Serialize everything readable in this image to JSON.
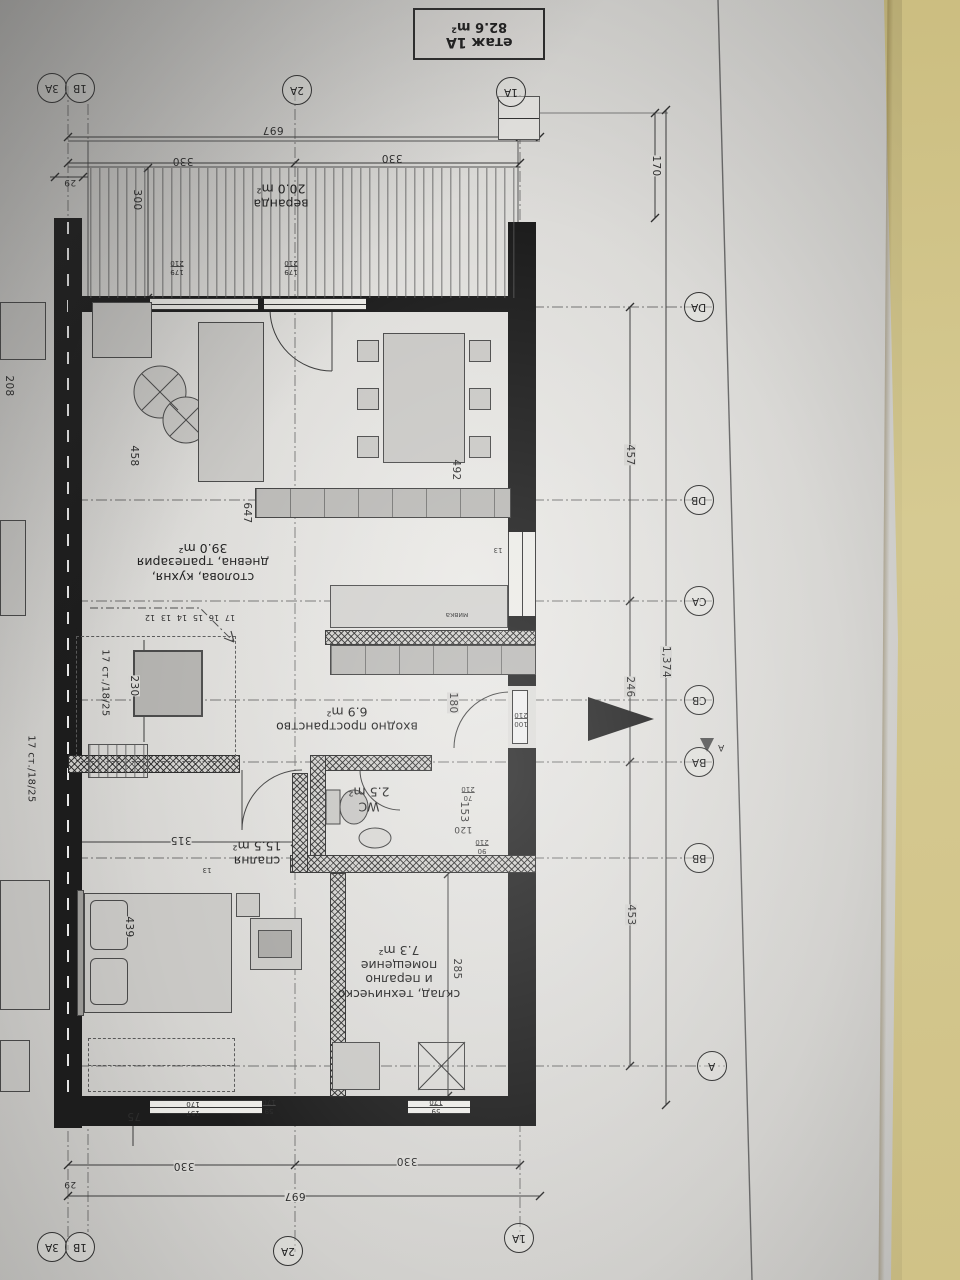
{
  "title_block": {
    "line1": "етаж 1А",
    "line2": "82.6 m²"
  },
  "rooms": {
    "veranda": {
      "name": "веранда",
      "area": "20.0 m²"
    },
    "living": {
      "name_line1": "столова, кухня,",
      "name_line2": "дневна, трапезария",
      "area": "39.0 m²"
    },
    "entry": {
      "name": "входно пространство",
      "area": "6.9 m²"
    },
    "wc": {
      "name": "WC",
      "area": "2.5 m²"
    },
    "bedroom": {
      "name": "спалня",
      "area": "15.5 m²"
    },
    "storage": {
      "name_line1": "склад, техническо",
      "name_line2": "и перално",
      "name_line3": "помещение",
      "area": "7.3 m²"
    }
  },
  "grid_bubbles": {
    "top_pair_left": "3А",
    "top_pair_right": "1В",
    "top_2a": "2А",
    "top_1a": "1А",
    "bottom_pair_left": "3А",
    "bottom_pair_right": "1В",
    "bottom_2a": "2А",
    "bottom_1a": "1А",
    "right": [
      "DA",
      "DB",
      "CA",
      "CB",
      "BA",
      "BB",
      "A"
    ],
    "section_marker": "А"
  },
  "dims": {
    "top_total": "697",
    "top_330_left": "330",
    "top_330_right": "330",
    "top_29": "29",
    "veranda_depth": "300",
    "right_170": "170",
    "right_457": "457",
    "right_246": "246",
    "right_453": "453",
    "right_total": "1,374",
    "bottom_total": "697",
    "bottom_330_left": "330",
    "bottom_330_right": "330",
    "bottom_29": "29",
    "bottom_75": "75",
    "living_458": "458",
    "table_492": "492",
    "counter_647": "647",
    "stair_230": "230",
    "stair_note": "17 ст./18/25",
    "stair_note_left": "17 ст./18/25",
    "mirror_208": "208",
    "entry_180": "180",
    "hall_153": "153",
    "hall_120": "120",
    "bedroom_315": "315",
    "bed_439": "439",
    "storage_285": "285",
    "wall_13_a": "13",
    "wall_13_b": "13"
  },
  "openings": {
    "window_top_left": {
      "w": "179",
      "h": "210"
    },
    "window_top_right": {
      "w": "179",
      "h": "210"
    },
    "entry_door": {
      "w": "100",
      "h": "210"
    },
    "wc_door": {
      "w": "70",
      "h": "210"
    },
    "hall_door": {
      "w": "90",
      "h": "210"
    },
    "bedroom_window": {
      "w": "157",
      "h": "170"
    },
    "hall_window": {
      "w": "59",
      "h": "170"
    },
    "storage_window": {
      "w": "59",
      "h": "170"
    }
  },
  "stair_numbers": [
    "12",
    "13",
    "14",
    "15",
    "16",
    "17"
  ],
  "kitchen": {
    "sink_label": "мивка"
  },
  "colors": {
    "paper": "#dcdbd8",
    "background": "#d2c58a",
    "line": "#3a3a3a",
    "wall": "#1d1d1d"
  }
}
